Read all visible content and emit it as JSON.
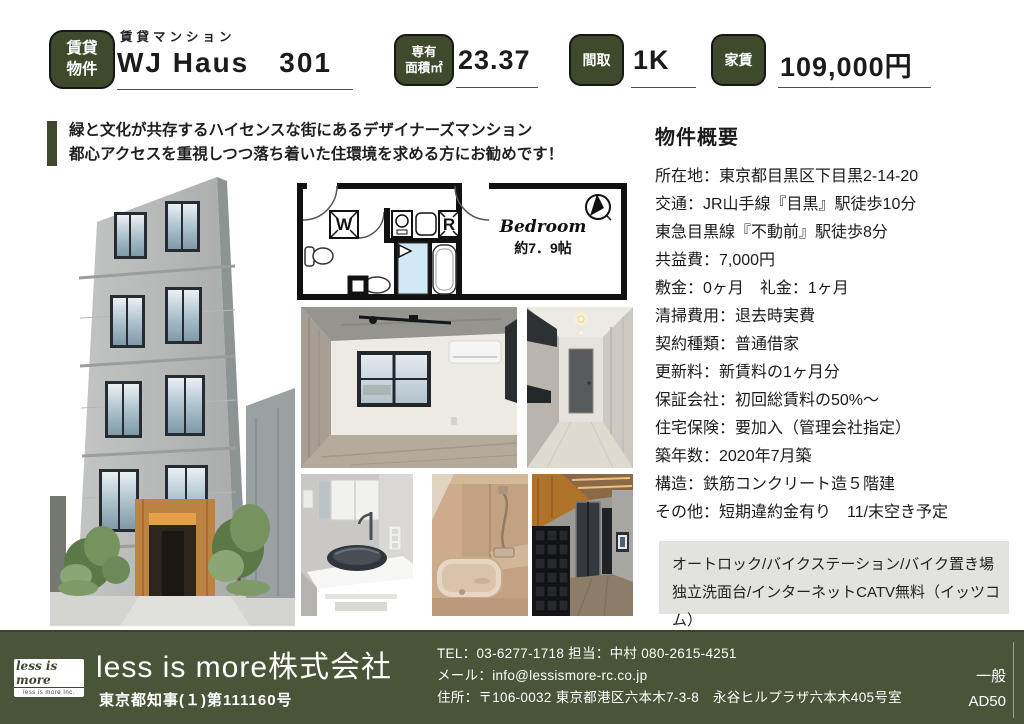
{
  "header": {
    "property_badge": {
      "line1": "賃貸",
      "line2": "物件"
    },
    "category": "賃貸マンション",
    "title": "WJ Haus　301",
    "area": {
      "badge_line1": "専有",
      "badge_line2": "面積㎡",
      "value": "23.37"
    },
    "layout": {
      "badge": "間取",
      "value": "1K"
    },
    "rent": {
      "badge": "家賃",
      "value": "109,000円"
    }
  },
  "catchphrase": {
    "line1": "緑と文化が共存するハイセンスな街にあるデザイナーズマンション",
    "line2": "都心アクセスを重視しつつ落ち着いた住環境を求める方にお勧めです！"
  },
  "floorplan": {
    "washer_label": "W",
    "fridge_label": "R",
    "bedroom_label": "Bedroom",
    "bedroom_size": "約7．9帖"
  },
  "overview": {
    "heading": "物件概要",
    "items": [
      "所在地：東京都目黒区下目黒2-14-20",
      "交通：JR山手線『目黒』駅徒歩10分",
      "東急目黒線『不動前』駅徒歩8分",
      "共益費：7,000円",
      "敷金：0ヶ月　礼金：1ヶ月",
      "清掃費用：退去時実費",
      "契約種類：普通借家",
      "更新料：新賃料の1ヶ月分",
      "保証会社：初回総賃料の50%～",
      "住宅保険：要加入（管理会社指定）",
      "築年数：2020年7月築",
      "構造：鉄筋コンクリート造５階建",
      "その他：短期違約金有り　11/末空き予定"
    ],
    "features": {
      "line1": "オートロック/バイクステーション/バイク置き場",
      "line2": "独立洗面台/インターネットCATV無料（イッツコム）"
    }
  },
  "footer": {
    "logo_signature": "less is more",
    "logo_caption": "less is more Inc.",
    "company": "less is more株式会社",
    "license": "東京都知事(１)第111160号",
    "tel": "TEL：03-6277-1718 担当：中村 080-2615-4251",
    "email": "メール：info@lessismore-rc.co.jp",
    "address": "住所：〒106-0032 東京都港区六本木7-3-8　永谷ヒルプラザ六本木405号室",
    "ad_class": "一般",
    "ad_code": "AD50"
  },
  "icons": {
    "compass": "north-arrow-compass"
  },
  "colors": {
    "accent_green": "#3e4a2b",
    "footer_green": "#4a5438",
    "features_bg": "#e2e2df",
    "floorplan_water": "#cfe9f6"
  }
}
